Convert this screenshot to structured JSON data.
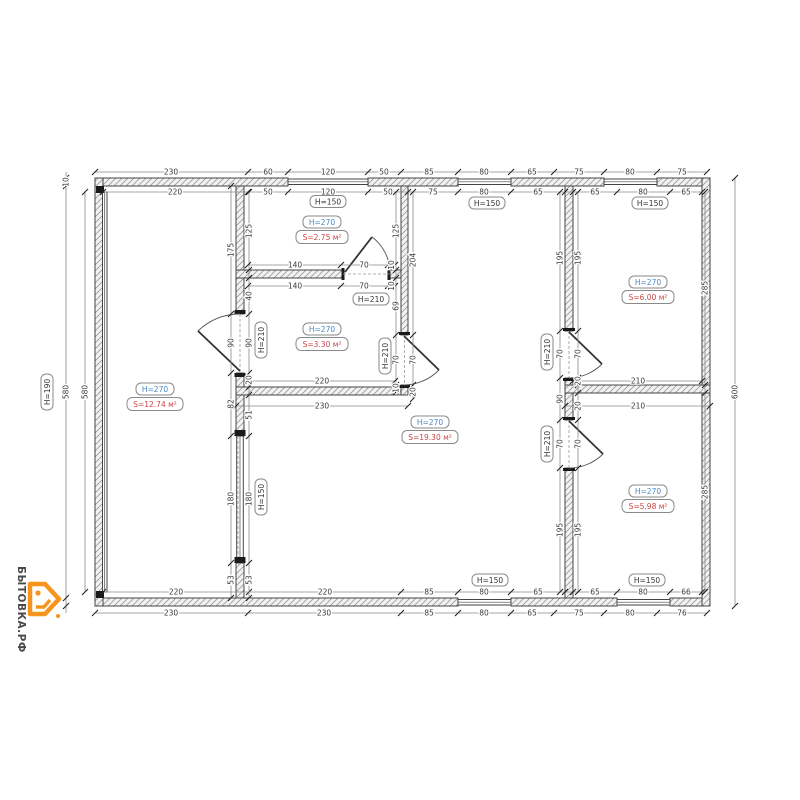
{
  "drawing": {
    "type": "floor-plan",
    "units": "cm"
  },
  "rooms": [
    {
      "h": "H=270",
      "s": "S=12.74 м²"
    },
    {
      "h": "H=270",
      "s": "S=2.75 м²"
    },
    {
      "h": "H=270",
      "s": "S=3.30 м²"
    },
    {
      "h": "H=270",
      "s": "S=19.30 м²"
    },
    {
      "h": "H=270",
      "s": "S=6.00 м²"
    },
    {
      "h": "H=270",
      "s": "S=5.98 м²"
    }
  ],
  "openings": {
    "windows": {
      "top1": "H=150",
      "top2": "H=150",
      "top3": "H=150",
      "bottom1": "H=150",
      "bottom2": "H=150",
      "inner": "H=150",
      "left": "H=190"
    },
    "doors": {
      "room2": "H=210",
      "wallA": "H=210",
      "wallB": "H=210",
      "wallC1": "H=210",
      "wallC2": "H=210"
    }
  },
  "dims": {
    "topOuter": [
      "230",
      "60",
      "120",
      "50",
      "85",
      "80",
      "65",
      "75",
      "80",
      "75"
    ],
    "topInner": [
      "220",
      "50",
      "120",
      "50",
      "75",
      "80",
      "65",
      "65",
      "80",
      "65"
    ],
    "bottomInner": [
      "220",
      "220",
      "85",
      "80",
      "65",
      "65",
      "80",
      "66"
    ],
    "bottomOuter": [
      "230",
      "230",
      "85",
      "80",
      "65",
      "75",
      "80",
      "76"
    ],
    "left": [
      "10",
      "580",
      "580"
    ],
    "right": [
      "285",
      "285",
      "600"
    ],
    "wallALeft": [
      "175",
      "90",
      "82",
      "180",
      "53"
    ],
    "wallARight": [
      "125",
      "40",
      "90",
      "20",
      "51",
      "180",
      "53"
    ],
    "wallBLeft": [
      "125",
      "69",
      "70",
      "10"
    ],
    "wallBRight": [
      "204",
      "70",
      "20"
    ],
    "wallCLeft": [
      "195",
      "70",
      "90",
      "70",
      "195"
    ],
    "wallCRight": [
      "195",
      "70",
      "20",
      "20",
      "70",
      "195"
    ],
    "room2WallAbove": [
      "140",
      "70",
      "10"
    ],
    "room2WallBelow": [
      "140",
      "70",
      "10"
    ],
    "middleWall": [
      "220",
      "230"
    ],
    "rightWall": [
      "210",
      "210"
    ]
  },
  "logo": {
    "text": "БЫТОВКА.РФ"
  },
  "colors": {
    "height_label": "#4a89c8",
    "area_label": "#cc4444",
    "logo": "#f7941d"
  }
}
